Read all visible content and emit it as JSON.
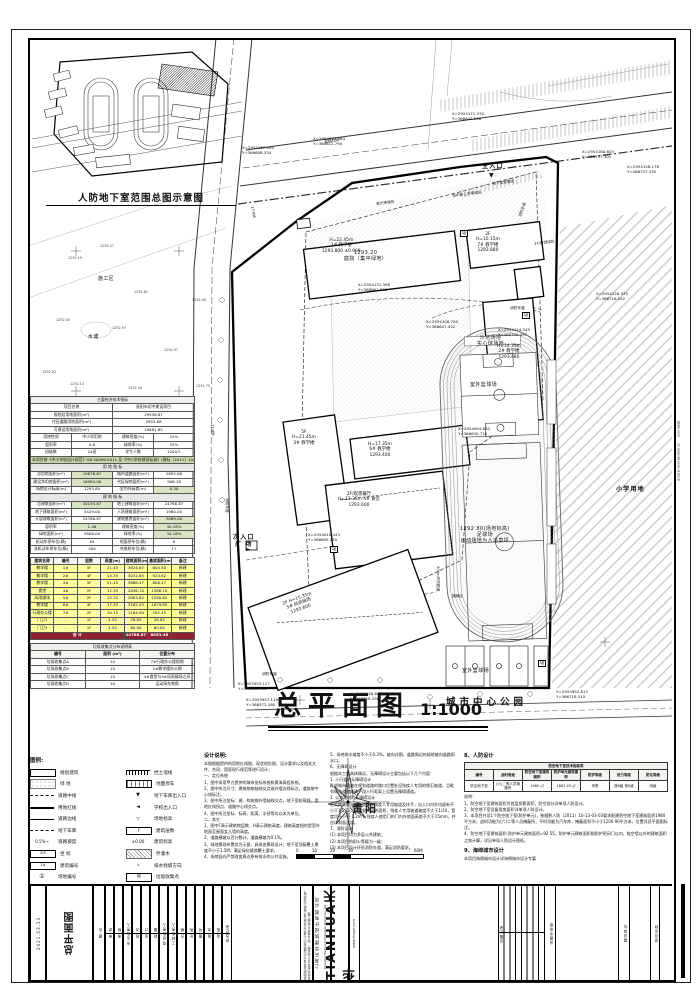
{
  "inset": {
    "title": "人防地下室范围总图示意图"
  },
  "main_title": {
    "text": "总平面图",
    "scale": "1:1000"
  },
  "compass": {
    "city": "贵阳",
    "scale_ticks": [
      "0",
      "10",
      "20",
      "30",
      "60M"
    ]
  },
  "plan": {
    "labels": [
      {
        "x": 242,
        "y": 146,
        "t": "X=2954167.000\nY=366608.334",
        "c": "xy"
      },
      {
        "x": 313,
        "y": 137,
        "t": "X=2954175.364\nY=366612.794",
        "c": "xy"
      },
      {
        "x": 452,
        "y": 112,
        "t": "X=2954171.370\nY=366642.548",
        "c": "xy"
      },
      {
        "x": 582,
        "y": 150,
        "t": "X=2954160.603\nY=366737.305",
        "c": "xy"
      },
      {
        "x": 627,
        "y": 165,
        "t": "X=2954158.176\nY=366757.335",
        "c": "xy"
      },
      {
        "x": 358,
        "y": 283,
        "t": "X=2954131.398\nY=366661.925",
        "c": "xy"
      },
      {
        "x": 426,
        "y": 320,
        "t": "X=2954108.700\nY=366647.452",
        "c": "xy"
      },
      {
        "x": 498,
        "y": 328,
        "t": "X=2954114.545\nY=366750.497",
        "c": "xy"
      },
      {
        "x": 458,
        "y": 427,
        "t": "X=2954094.640\nY=366630.710",
        "c": "xy"
      },
      {
        "x": 308,
        "y": 533,
        "t": "X=2954010.443\nY=366695.470",
        "c": "xy"
      },
      {
        "x": 238,
        "y": 682,
        "t": "X=2953953.127\nY=366608.302",
        "c": "xy"
      },
      {
        "x": 246,
        "y": 698,
        "t": "X=2953957.119\nY=366572.180",
        "c": "xy"
      },
      {
        "x": 350,
        "y": 692,
        "t": "X=2953946.680\nY=366628.356",
        "c": "xy"
      },
      {
        "x": 556,
        "y": 690,
        "t": "X=2953952.813\nY=366718.513",
        "c": "xy"
      },
      {
        "x": 596,
        "y": 292,
        "t": "X=2954126.335\nY=366716.542",
        "c": "xy"
      },
      {
        "x": 322,
        "y": 238,
        "t": "H=22.45m\n1# 教学楼\n1293.800 ±0.000",
        "c": "bld"
      },
      {
        "x": 476,
        "y": 232,
        "t": "2F\nH=10.15m\n7# 教学楼\n1293.880",
        "c": "bld"
      },
      {
        "x": 534,
        "y": 242,
        "t": "2F/屋顶绿化",
        "c": "tiny",
        "r": -7
      },
      {
        "x": 497,
        "y": 344,
        "t": "H=14.35m\n2# 教学楼\n1293.480",
        "c": "bld"
      },
      {
        "x": 292,
        "y": 430,
        "t": "5F\nH=21.45m\n3# 教学楼",
        "c": "bld"
      },
      {
        "x": 368,
        "y": 442,
        "t": "H=17.35m\n6# 教学楼\n1293.400",
        "c": "bld"
      },
      {
        "x": 344,
        "y": 250,
        "t": "1293.20\n庭院（集中绿地）",
        "c": "area"
      },
      {
        "x": 338,
        "y": 492,
        "t": "2F/观景餐厅\nH=12.35m 4# 食堂\n1293.600",
        "c": "bld"
      },
      {
        "x": 282,
        "y": 602,
        "t": "2F H=15.35m\n5# 风雨操场\n1293.600",
        "c": "bld",
        "r": -20
      },
      {
        "x": 233,
        "y": 534,
        "t": "次入口\n广 场",
        "c": "big"
      },
      {
        "x": 482,
        "y": 163,
        "t": "主入口",
        "c": "big"
      },
      {
        "x": 477,
        "y": 335,
        "t": "沙坑场地\n实心球场地",
        "c": "area"
      },
      {
        "x": 470,
        "y": 382,
        "t": "室外篮球场",
        "c": "area"
      },
      {
        "x": 460,
        "y": 526,
        "t": "1292.80(场地标高)\n足球场\n运动场地为人造草坪",
        "c": "area"
      },
      {
        "x": 462,
        "y": 668,
        "t": "室外篮球场",
        "c": "area"
      },
      {
        "x": 452,
        "y": 594,
        "t": "器械区",
        "c": "tiny"
      },
      {
        "x": 440,
        "y": 566,
        "t": "300m环形跑道",
        "c": "tiny",
        "r": 90
      },
      {
        "x": 616,
        "y": 486,
        "t": "小学用地",
        "c": "big"
      },
      {
        "x": 446,
        "y": 697,
        "t": "城市中心公园",
        "c": "park"
      },
      {
        "x": 98,
        "y": 276,
        "t": "施工区",
        "c": "area"
      },
      {
        "x": 88,
        "y": 334,
        "t": "水塘",
        "c": "area"
      },
      {
        "x": 510,
        "y": 306,
        "t": "消防车道",
        "c": "tiny"
      },
      {
        "x": 262,
        "y": 672,
        "t": "消防车道",
        "c": "tiny"
      },
      {
        "x": 229,
        "y": 498,
        "t": "消防车道",
        "c": "tiny",
        "r": 90
      },
      {
        "x": 518,
        "y": 216,
        "t": "消防车道",
        "c": "tiny",
        "r": -70
      },
      {
        "x": 324,
        "y": 140,
        "t": "道路红线",
        "c": "tiny",
        "r": -8
      },
      {
        "x": 492,
        "y": 182,
        "t": "地下室轮廓线",
        "c": "tiny",
        "r": -7
      },
      {
        "x": 452,
        "y": 194,
        "t": "初中部上学等候区",
        "c": "tiny",
        "r": -7
      },
      {
        "x": 376,
        "y": 202,
        "t": "家长等候区",
        "c": "tiny",
        "r": -7
      },
      {
        "x": 254,
        "y": 206,
        "t": "27.0M",
        "c": "tiny",
        "r": 80
      },
      {
        "x": 214,
        "y": 424,
        "t": "27.0M",
        "c": "tiny",
        "r": 86
      },
      {
        "x": 68,
        "y": 256,
        "t": "1292.19",
        "c": "spot"
      },
      {
        "x": 100,
        "y": 244,
        "t": "1292.27",
        "c": "spot"
      },
      {
        "x": 134,
        "y": 290,
        "t": "1292.61",
        "c": "spot"
      },
      {
        "x": 112,
        "y": 326,
        "t": "1292.97",
        "c": "spot"
      },
      {
        "x": 56,
        "y": 318,
        "t": "1292.45",
        "c": "spot"
      },
      {
        "x": 42,
        "y": 370,
        "t": "1292.52",
        "c": "spot"
      },
      {
        "x": 70,
        "y": 382,
        "t": "1292.14",
        "c": "spot"
      },
      {
        "x": 128,
        "y": 386,
        "t": "1292.16",
        "c": "spot"
      },
      {
        "x": 192,
        "y": 298,
        "t": "1292.40",
        "c": "spot"
      },
      {
        "x": 196,
        "y": 384,
        "t": "1291.75",
        "c": "spot"
      },
      {
        "x": 164,
        "y": 348,
        "t": "1292.37",
        "c": "spot"
      },
      {
        "x": 522,
        "y": 312,
        "t": "圾",
        "c": "trash"
      },
      {
        "x": 460,
        "y": 230,
        "t": "圾",
        "c": "trash"
      },
      {
        "x": 330,
        "y": 546,
        "t": "圾",
        "c": "trash"
      },
      {
        "x": 538,
        "y": 660,
        "t": "圾",
        "c": "trash"
      },
      {
        "x": 489,
        "y": 172,
        "t": "▼",
        "c": "arrow"
      },
      {
        "x": 246,
        "y": 546,
        "t": "►",
        "c": "arrow"
      }
    ]
  },
  "tables": {
    "econ": {
      "rows": [
        {
          "cells": [
            {
              "t": "主要经济技术指标",
              "s": 4,
              "cls": "ttl"
            }
          ]
        },
        {
          "cells": [
            {
              "t": "项目名称",
              "s": 2
            },
            {
              "t": "贵阳市初中建设项目",
              "s": 2
            }
          ]
        },
        {
          "cells": [
            {
              "t": "规划总用地面积(m²)",
              "s": 2
            },
            {
              "t": "29936.87",
              "s": 2
            }
          ]
        },
        {
          "cells": [
            {
              "t": "代征道路用地面积(m²)",
              "s": 2
            },
            {
              "t": "2953.68",
              "s": 2
            }
          ]
        },
        {
          "cells": [
            {
              "t": "可建设用地面积(m²)",
              "s": 2
            },
            {
              "t": "19881.85",
              "s": 2
            }
          ]
        },
        {
          "cells": [
            "用地性质",
            "中小学用地",
            "建筑密度(%)",
            "25%"
          ]
        },
        {
          "cells": [
            "容积率",
            "0.8",
            "绿地率(%)",
            "35%"
          ]
        },
        {
          "cells": [
            "班级数",
            "24班",
            "学生人数",
            "1200人"
          ]
        },
        {
          "cells": [
            {
              "t": "本项目按《中小学校设计规范》GB 50099-2011 及《中小学校建设标准》(建标〔2011〕102号) 进行设计并满足相关规范要求",
              "s": 4,
              "g": true,
              "cls": "bnr"
            }
          ]
        },
        {
          "cells": [
            {
              "t": "用 地 指 标",
              "s": 4,
              "cls": "sub"
            }
          ]
        },
        {
          "cells": [
            "总用地面积(m²)",
            {
              "t": "19876.67",
              "g": true
            },
            "城市道路面积(m²)",
            "2892.68"
          ]
        },
        {
          "cells": [
            "建设净用地面积(m²)",
            {
              "t": "16984.00",
              "g": true
            },
            "代征绿地面积(m²)",
            "908.18"
          ]
        },
        {
          "cells": [
            "场地设计标高(m)",
            "1293.80",
            "室内外高差(m)",
            {
              "t": "0.30",
              "g": true
            }
          ]
        },
        {
          "cells": [
            {
              "t": "建 筑 指 标",
              "s": 4,
              "cls": "sub"
            }
          ]
        },
        {
          "cells": [
            "总建筑面积(m²)",
            {
              "t": "30195.87",
              "g": true
            },
            "地上建筑面积(m²)",
            "24766.87"
          ]
        },
        {
          "cells": [
            "地下建筑面积(m²)",
            "5429.00",
            "人防建筑面积(m²)",
            "1980.00"
          ]
        },
        {
          "cells": [
            "计容建筑面积(m²)",
            "24766.87",
            "建筑基底面积(m²)",
            {
              "t": "5089.00",
              "g": true
            }
          ]
        },
        {
          "cells": [
            "容积率",
            {
              "t": "1.46",
              "g": true
            },
            "建筑密度(%)",
            {
              "t": "30.18%",
              "g": true
            }
          ]
        },
        {
          "cells": [
            "绿地面积(m²)",
            "5806.00",
            "绿地率(%)",
            {
              "t": "34.18%",
              "g": true
            }
          ]
        },
        {
          "cells": [
            "机动车停车位(辆)",
            "84",
            "地面停车位(辆)",
            "8"
          ]
        },
        {
          "cells": [
            "非机动车停车位(辆)",
            "300",
            "充电桩车位(辆)",
            "17"
          ]
        }
      ]
    },
    "buildings": {
      "rows": [
        {
          "cls": "thd",
          "cells": [
            "建筑名称",
            "编号",
            "层数",
            "高度(m)",
            "建筑面积(m²)",
            "基底面积(m²)",
            "备注"
          ]
        },
        {
          "cls": "y",
          "cells": [
            "教学楼",
            "1#",
            "5F",
            "21.45",
            "3824.67",
            "804.50",
            "新建"
          ]
        },
        {
          "cls": "y",
          "cells": [
            "教学楼",
            "2#",
            "4F",
            "14.35",
            "3032.85",
            "924.62",
            "新建"
          ]
        },
        {
          "cls": "y",
          "cells": [
            "教学楼",
            "3#",
            "5F",
            "21.45",
            "3886.47",
            "806.47",
            "新建"
          ]
        },
        {
          "cls": "y",
          "cells": [
            "食堂",
            "4#",
            "2F",
            "12.35",
            "2836.10",
            "1366.10",
            "新建"
          ]
        },
        {
          "cls": "y",
          "cells": [
            "风雨操场",
            "5#",
            "2F",
            "15.35",
            "2883.62",
            "1590.62",
            "新建"
          ]
        },
        {
          "cls": "y",
          "cells": [
            "教学楼",
            "6#",
            "4F",
            "17.35",
            "3162.55",
            "1879.85",
            "新建"
          ]
        },
        {
          "cls": "y",
          "cells": [
            "行政办公楼",
            "7#",
            "2F",
            "10.15",
            "1184.90",
            "592.45",
            "新建"
          ]
        },
        {
          "cls": "y",
          "cells": [
            "门卫1",
            "-",
            "1F",
            "4.50",
            "28.85",
            "28.85",
            "新建"
          ]
        },
        {
          "cls": "y",
          "cells": [
            "门卫2",
            "-",
            "1F",
            "4.50",
            "60.00",
            "60.00",
            "新建"
          ]
        },
        {
          "cls": "tot",
          "cells": [
            {
              "t": "合 计",
              "s": 4
            },
            {
              "t": "24766.87"
            },
            {
              "t": "8053.46"
            },
            {
              "t": ""
            }
          ]
        }
      ]
    },
    "garbage": {
      "rows": [
        {
          "cells": [
            {
              "t": "垃圾收集点分布说明表",
              "s": 3,
              "cls": "ttl"
            }
          ]
        },
        {
          "cls": "thd",
          "cells": [
            "编号",
            "面积 (m²)",
            "位置分布"
          ]
        },
        {
          "cells": [
            "垃圾收集点A",
            "10",
            "7#行政办公楼前侧"
          ]
        },
        {
          "cells": [
            "垃圾收集点B",
            "10",
            "2#教学楼办公侧"
          ]
        },
        {
          "cells": [
            "垃圾收集点C",
            "10",
            "4#食堂与5#风雨操场之间"
          ]
        },
        {
          "cells": [
            "垃圾收集点D",
            "10",
            "运动场东南角"
          ]
        }
      ]
    },
    "renfang": {
      "rows": [
        {
          "cells": [
            {
              "t": "防空地下室技术指标表",
              "s": 7,
              "cls": "ttl"
            }
          ]
        },
        {
          "cls": "thd",
          "cells": [
            "编号",
            "战时用途",
            "防空地下室建筑面积",
            "防护单元建筑面积",
            "防护等级",
            "抗力等级",
            "防化等级"
          ]
        },
        {
          "cells": [
            "防空地下室",
            "(六)二等人员掩蔽所",
            "1980 ㎡",
            "1887.45 ㎡",
            "甲类",
            "核6级 常6级",
            "丙级"
          ]
        }
      ]
    }
  },
  "legend": {
    "title": "图例:",
    "left": [
      {
        "sym": "building",
        "label": "规划建筑"
      },
      {
        "sym": "green",
        "label": "绿  地"
      },
      {
        "sym": "centerline",
        "label": "道路中线"
      },
      {
        "sym": "redline",
        "label": "用地红线"
      },
      {
        "sym": "roadedge",
        "label": "道路边线"
      },
      {
        "sym": "garage",
        "label": "地下车库"
      },
      {
        "sym": "slope",
        "label": "道路坡度",
        "glyph": "0.5%→"
      },
      {
        "sym": "coord",
        "label": "坐  标",
        "glyph": "X/Y"
      },
      {
        "sym": "bno",
        "label": "建筑编号",
        "glyph": "1#"
      },
      {
        "sym": "sno",
        "label": "场地编号",
        "glyph": "①"
      }
    ],
    "right": [
      {
        "sym": "wall",
        "label": "挡土墙线"
      },
      {
        "sym": "parking",
        "label": "地面停车"
      },
      {
        "sym": "g-entry",
        "label": "地下车库出入口",
        "glyph": "▼"
      },
      {
        "sym": "s-entry",
        "label": "学校出入口",
        "glyph": "◄"
      },
      {
        "sym": "elev",
        "label": "场地标高",
        "glyph": "▽"
      },
      {
        "sym": "floors",
        "label": "建筑层数",
        "glyph": "F"
      },
      {
        "sym": "belev",
        "label": "建筑标高",
        "glyph": "±0.00"
      },
      {
        "sym": "tree",
        "label": "乔灌木"
      },
      {
        "sym": "drain",
        "label": "排水找坡方向",
        "glyph": "↘"
      },
      {
        "sym": "trash",
        "label": "垃圾收集点",
        "glyph": "圾"
      }
    ]
  },
  "notes": {
    "title": "设计说明:",
    "colA": [
      "本图根据提供的用地红线图、现状地形图、设计要求以及相关文件、合同、国家现行规范等进行设计；",
      "一、定位系统",
      "1、图中采用甲方提供的城市坐标系统和黄海高程系统。",
      "2、图中所注尺寸：建筑物按轴线交点或外墙边线标注，道路按中心线标注。",
      "3、图中所注坐标：建、构筑物外墙轴线交点，地下室轮廓线、用地红线拐点、道路中心线交点。",
      "4、图中所注坐标、标高、距离、半径等均以米为单位。",
      "二、其它",
      "1、图中F表示建筑物层数，H表示建筑高度，建筑高度指的是室外地面至屋面女儿墙的高度。",
      "2、道路横坡以百分数计，道路横坡为0.1%。",
      "3、绿地景观布置仅为示意，具体由景观设计；地下室顶板覆土厚度不小于1.5M，满足绿化植栽覆土要求。",
      "4、场地竖向严禁改变周边原有排水的公共设施。"
    ],
    "colB": [
      "5、场地排水坡度不小于0.3%，坡向详图，道路周边的绿地坡向道路雨水口。",
      "6、无障碍设计",
      "根据本工程具体情况，无障碍设计主要包括以下几个内容：",
      "1. 人行道的无障碍设计",
      "毗邻城市道路在规划道路的路口位置处设残疾人专用的缘石坡道，且毗邻城市道路每隔一段人行距离上设置无障碍通道。",
      "2. 公共建筑的无障碍设计",
      "在公共建筑出入口处设有残疾人专用坡道及扶手，出入口内外均留有不小于1.5x1.5m 的轮椅回转面积，残疾人专用坡道坡度不大于1/20，宽度均不小于 1.2m ，残疾人使用门的门内外地面高差不大于15mm，并应以斜面过渡。",
      "7、消防设计",
      "(1) 本项目均为多层公共建筑；",
      "(2) 本项目的耐火等级为一级；",
      "(3) 本项目设计环形消防车道，满足消防要求。"
    ],
    "renfang_title": "8、人防设计",
    "renfang_notes": [
      "说明：",
      "1、防空地下室建筑面积为首层投影面积，防空部分详单项人防设计。",
      "2、防空地下室设备用房面积详单项人防设计。",
      "3、本项目共设1个防空地下室(防护单元)，依据黔人防〔2011〕10-13-03-03要求配建防空地下室建筑面积1980平方米，战时功能为(六)二等人员掩蔽所，平时功能为汽车库，掩蔽面积不小于1200.90平方米，位置详总平面图标注。",
      "4、防空地下室建筑面积-防护单元建筑面积=92.55，防护单元建筑面积指防护密闭门以内、临空墙以外的建筑面积之和计算，详见单项人防设计图纸。"
    ],
    "sponge_title": "9、海绵城市设计",
    "sponge_body": "本项目海绵城市设计详海绵城市设计专篇"
  },
  "titleblock": {
    "fields": [
      {
        "x": 2,
        "w": 14,
        "t": "2021.03.13",
        "fs": 4
      },
      {
        "x": 18,
        "w": 46,
        "t": "总平面图",
        "fs": 10,
        "b": 1
      },
      {
        "x": 64,
        "w": 12,
        "t": "图 名",
        "fs": 3.5
      },
      {
        "x": 76,
        "w": 9,
        "t": "审 定"
      },
      {
        "x": 85,
        "w": 9,
        "t": "审 核"
      },
      {
        "x": 94,
        "w": 9,
        "t": "专业负责人"
      },
      {
        "x": 103,
        "w": 9,
        "t": "校 对"
      },
      {
        "x": 112,
        "w": 9,
        "t": "设 计"
      },
      {
        "x": 121,
        "w": 9,
        "t": "制 图"
      },
      {
        "x": 130,
        "w": 9,
        "t": "项目负责人"
      },
      {
        "x": 139,
        "w": 9,
        "t": "工种负责人"
      },
      {
        "x": 148,
        "w": 9,
        "t": "日 期"
      },
      {
        "x": 157,
        "w": 9,
        "t": "比 例"
      },
      {
        "x": 166,
        "w": 9,
        "t": "图 号"
      },
      {
        "x": 175,
        "w": 9,
        "t": "版 次"
      },
      {
        "x": 184,
        "w": 9,
        "t": "会 签"
      },
      {
        "x": 193,
        "w": 9,
        "t": "修改记录"
      },
      {
        "x": 516,
        "w": 10,
        "t": "出图专用章",
        "fs": 3.5
      },
      {
        "x": 590,
        "w": 10,
        "t": "建设单位",
        "fs": 3.5
      },
      {
        "x": 622,
        "w": 8,
        "t": "项目名称",
        "fs": 3.5
      }
    ],
    "grid_label": "出图记录",
    "logo": "TIANHUA天华",
    "company_cn": "上海天华建筑设计有限公司",
    "company_en": "Shanghai Tianhua Architecture Design Co.,Ltd.",
    "web": "www.thape.com",
    "disclaimer": "本图纸及其设计内容版权归上海天华建筑设计有限公司所有，未经书面许可不得复制、转让或用于其他工程",
    "rmargin": "贵阳市初中建设项目 · 总平面图"
  }
}
